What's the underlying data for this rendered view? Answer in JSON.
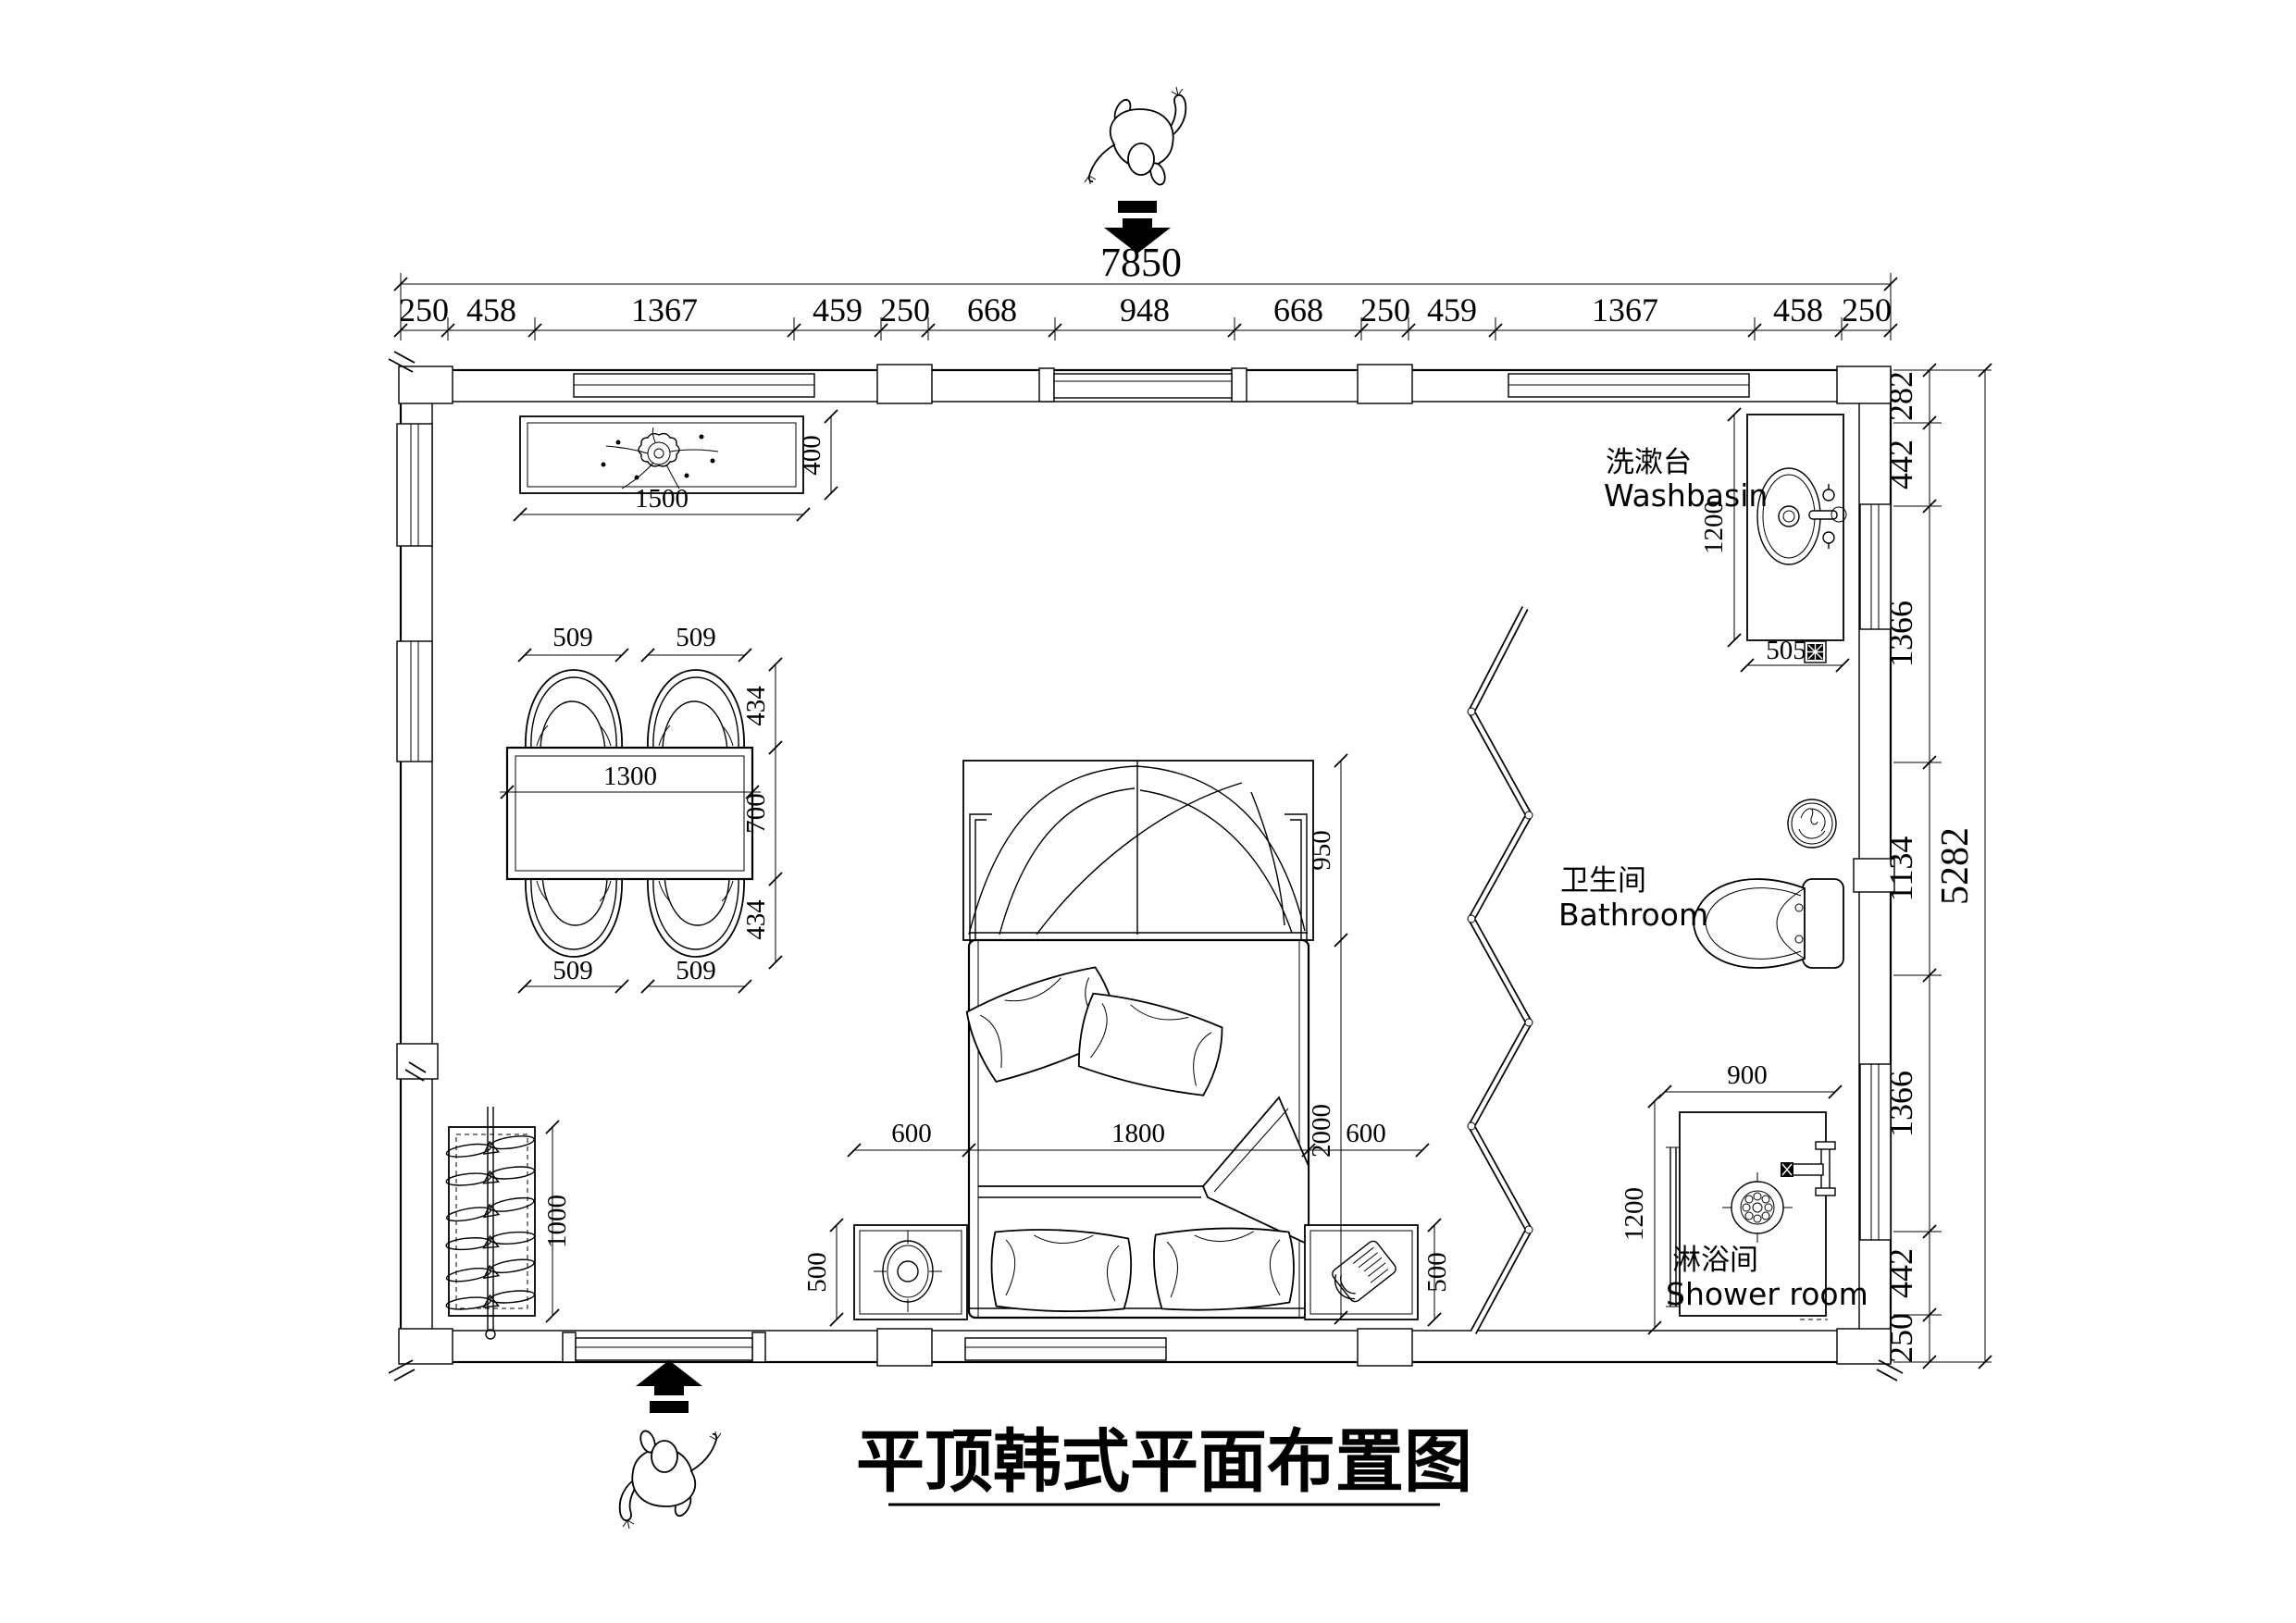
{
  "meta": {
    "title": "平顶韩式平面布置图"
  },
  "labels": {
    "washbasin_zh": "洗漱台",
    "washbasin_en": "Washbasin",
    "bathroom_zh": "卫生间",
    "bathroom_en": "Bathroom",
    "shower_zh": "淋浴间",
    "shower_en": "Shower room"
  },
  "dims": {
    "top_total": "7850",
    "top_segments": [
      "250",
      "458",
      "1367",
      "459",
      "250",
      "668",
      "948",
      "668",
      "250",
      "459",
      "1367",
      "458",
      "250"
    ],
    "right_total": "5282",
    "right_segments": [
      "282",
      "442",
      "1366",
      "1134",
      "1366",
      "442",
      "250"
    ],
    "console": {
      "w": "1500",
      "d": "400"
    },
    "dining": {
      "chair_top": [
        "509",
        "509"
      ],
      "chair_bottom": [
        "509",
        "509"
      ],
      "table_w": "1300",
      "depth": [
        "434",
        "700",
        "434"
      ]
    },
    "bed": {
      "left": "600",
      "width": "1800",
      "right": "600",
      "length": "2000",
      "canopy": "950",
      "nightstand_left": "500",
      "nightstand_right": "500"
    },
    "rack_h": "1000",
    "washbasin": {
      "l": "1200",
      "w": "505"
    },
    "shower": {
      "w": "900",
      "d": "1200"
    }
  }
}
